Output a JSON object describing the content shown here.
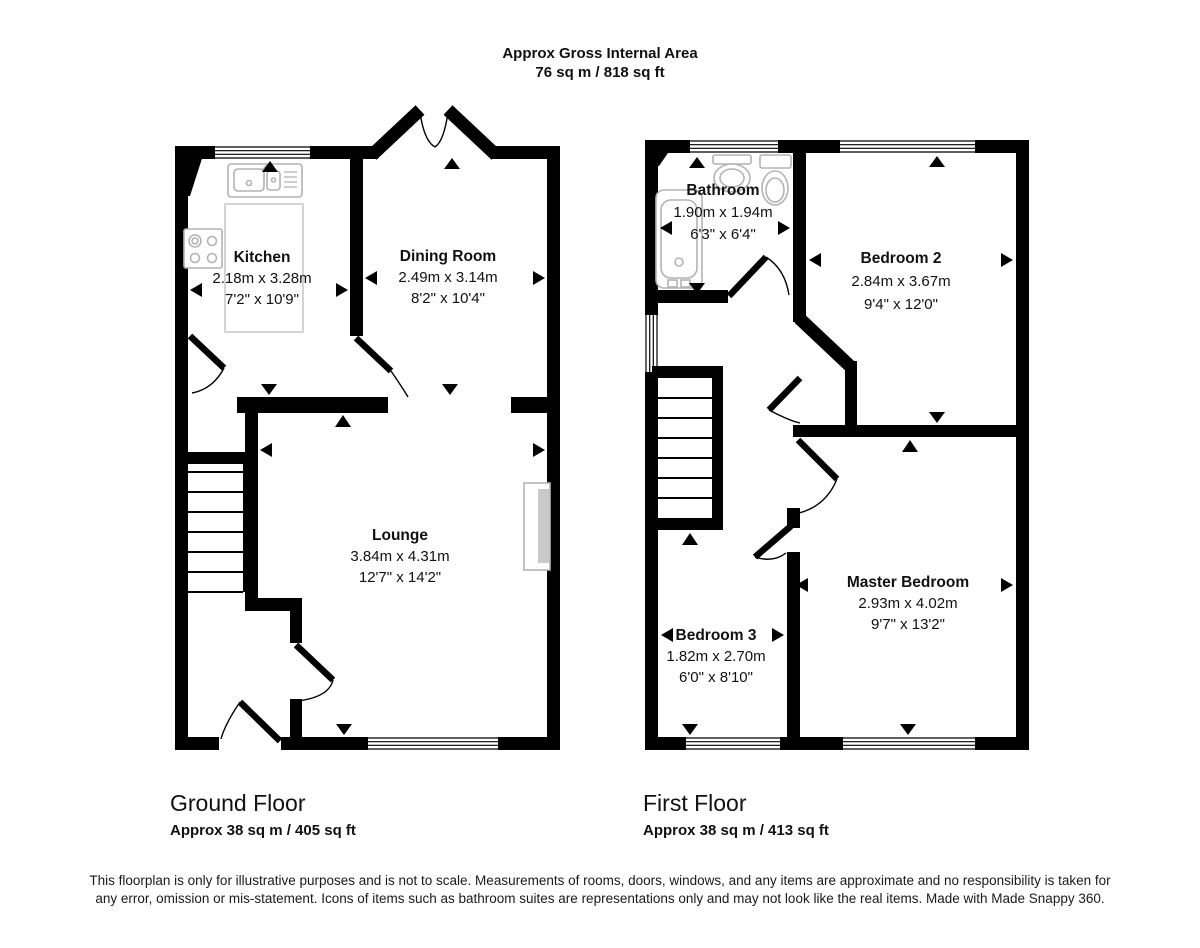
{
  "title": {
    "line1": "Approx Gross Internal Area",
    "line2": "76 sq m / 818 sq ft"
  },
  "ground_floor": {
    "label": "Ground Floor",
    "area": "Approx 38 sq m / 405 sq ft",
    "rooms": [
      {
        "name": "Kitchen",
        "metric": "2.18m x 3.28m",
        "imperial": "7'2\" x 10'9\""
      },
      {
        "name": "Dining Room",
        "metric": "2.49m x 3.14m",
        "imperial": "8'2\" x 10'4\""
      },
      {
        "name": "Lounge",
        "metric": "3.84m x 4.31m",
        "imperial": "12'7\" x 14'2\""
      }
    ]
  },
  "first_floor": {
    "label": "First Floor",
    "area": "Approx 38 sq m / 413 sq ft",
    "rooms": [
      {
        "name": "Bathroom",
        "metric": "1.90m x 1.94m",
        "imperial": "6'3\" x 6'4\""
      },
      {
        "name": "Bedroom 2",
        "metric": "2.84m x 3.67m",
        "imperial": "9'4\" x 12'0\""
      },
      {
        "name": "Master Bedroom",
        "metric": "2.93m x 4.02m",
        "imperial": "9'7\" x 13'2\""
      },
      {
        "name": "Bedroom 3",
        "metric": "1.82m x 2.70m",
        "imperial": "6'0\" x 8'10\""
      }
    ]
  },
  "disclaimer": "This floorplan is only for illustrative purposes and is not to scale. Measurements of rooms, doors, windows, and any items are approximate and no responsibility is taken for any error, omission or mis-statement. Icons of items such as bathroom suites are representations only and may not look like the real items. Made with Made Snappy 360.",
  "colors": {
    "wall": "#000000",
    "fixture_outline": "#b3b3b3",
    "fireplace_fill": "#c9c9c9",
    "text": "#111111"
  }
}
